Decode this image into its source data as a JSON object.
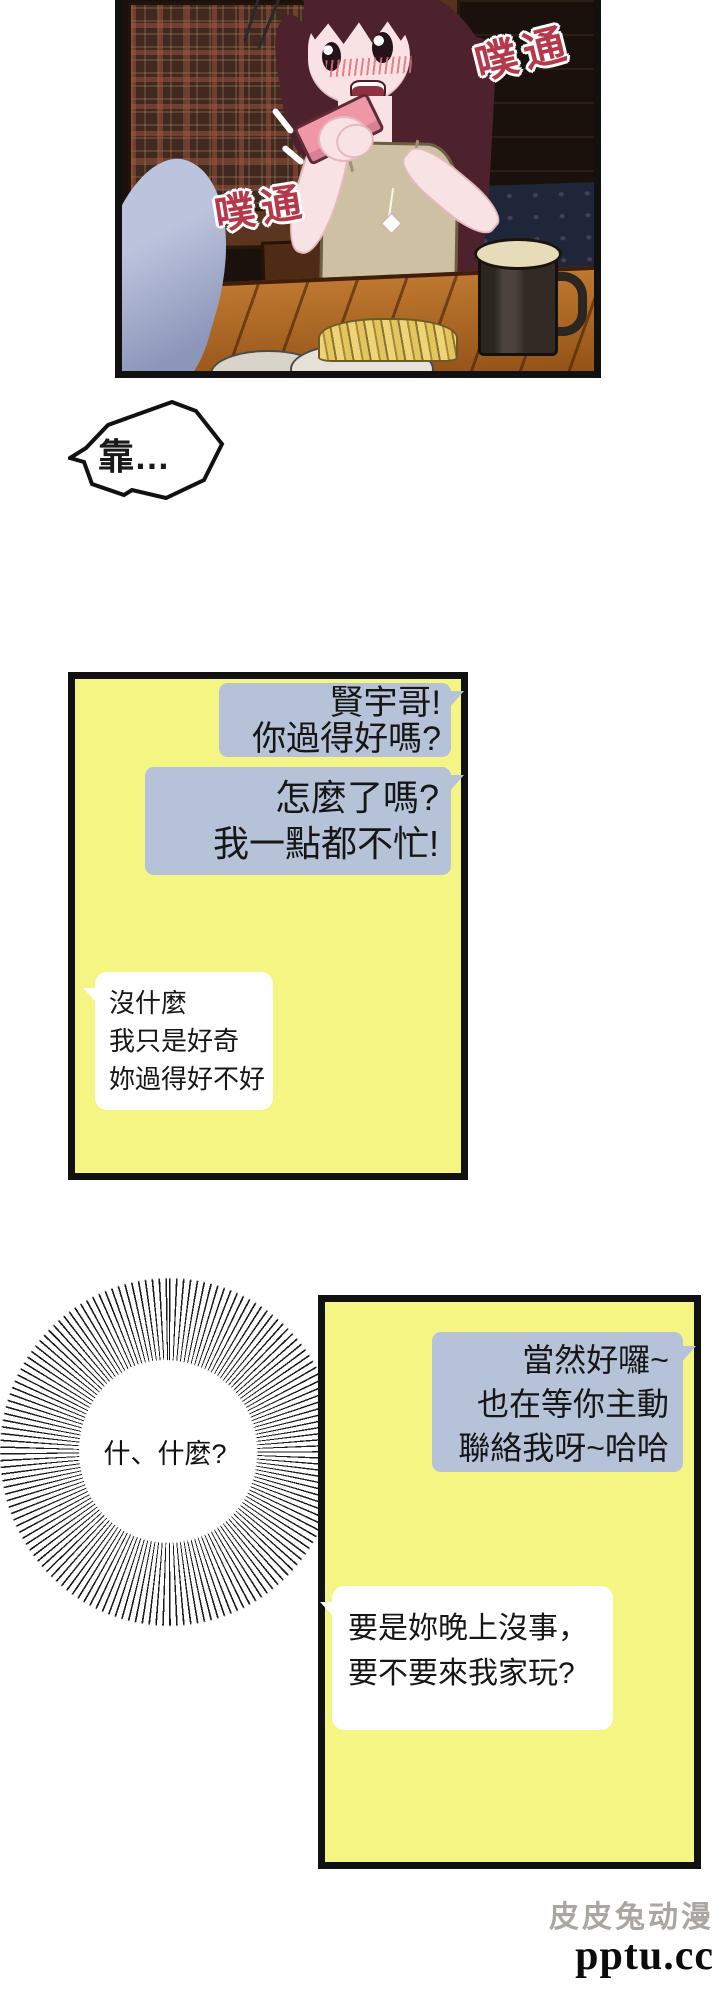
{
  "panel_art": {
    "description": "woman with long dark-red hair blushing and reading a pink phone at a wooden pub table, beer mug and plate of fries in front",
    "sfx_top_right": "噗通",
    "sfx_mid_left": "噗通",
    "sfx_color": "#b5394a"
  },
  "shout_bubble": {
    "text": "靠…"
  },
  "chat_panel_1": {
    "bg_color": "#f5f584",
    "bubble_blue_color": "#b5c2d7",
    "bubbles": [
      {
        "side": "right",
        "lines": [
          "賢宇哥!",
          "你過得好嗎?"
        ]
      },
      {
        "side": "right",
        "lines": [
          "怎麼了嗎?",
          "我一點都不忙!"
        ]
      },
      {
        "side": "left",
        "lines": [
          "沒什麼",
          "我只是好奇",
          "妳過得好不好"
        ]
      }
    ]
  },
  "burst_bubble": {
    "text": "什、什麼?"
  },
  "chat_panel_2": {
    "bg_color": "#f5f584",
    "bubble_blue_color": "#b5c2d7",
    "bubbles": [
      {
        "side": "right",
        "lines": [
          "當然好囉~",
          "也在等你主動",
          "聯絡我呀~哈哈"
        ]
      },
      {
        "side": "left",
        "lines": [
          "要是妳晚上沒事，",
          "要不要來我家玩?"
        ]
      }
    ]
  },
  "watermark": {
    "site_name": "皮皮兔动漫",
    "url": "pptu.cc"
  }
}
